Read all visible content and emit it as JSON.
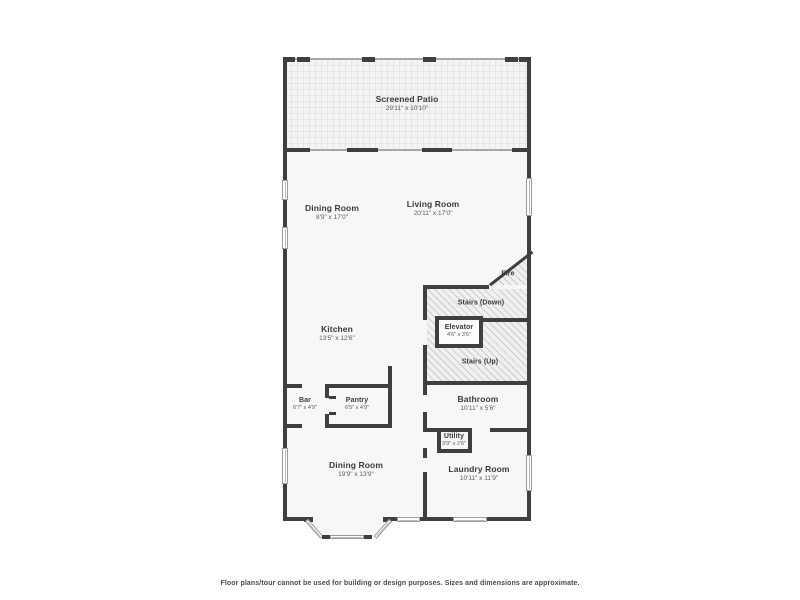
{
  "rooms": {
    "screened_patio": {
      "name": "Screened Patio",
      "dims": "29'11\" x 10'10\""
    },
    "dining_room_top": {
      "name": "Dining Room",
      "dims": "8'9\" x 17'0\""
    },
    "living_room": {
      "name": "Living Room",
      "dims": "20'11\" x 17'0\""
    },
    "fire": {
      "name": "Fire"
    },
    "stairs_down": {
      "name": "Stairs (Down)"
    },
    "elevator": {
      "name": "Elevator",
      "dims": "4'6\" x 3'6\""
    },
    "stairs_up": {
      "name": "Stairs (Up)"
    },
    "kitchen": {
      "name": "Kitchen",
      "dims": "13'5\" x 12'6\""
    },
    "bar": {
      "name": "Bar",
      "dims": "6'7\" x 4'9\""
    },
    "pantry": {
      "name": "Pantry",
      "dims": "6'5\" x 4'9\""
    },
    "bathroom": {
      "name": "Bathroom",
      "dims": "10'11\" x 5'6\""
    },
    "utility": {
      "name": "Utility",
      "dims": "3'9\" x 2'6\""
    },
    "laundry_room": {
      "name": "Laundry Room",
      "dims": "10'11\" x 11'9\""
    },
    "dining_room_bottom": {
      "name": "Dining Room",
      "dims": "19'9\" x 13'9\""
    }
  },
  "disclaimer": "Floor plans/tour cannot be used for building or design purposes. Sizes and dimensions are approximate.",
  "colors": {
    "wall": "#3f3f3f",
    "room_fill": "#f7f7f7",
    "hatch_line": "#cdcdcd",
    "text": "#3a3a3a"
  }
}
